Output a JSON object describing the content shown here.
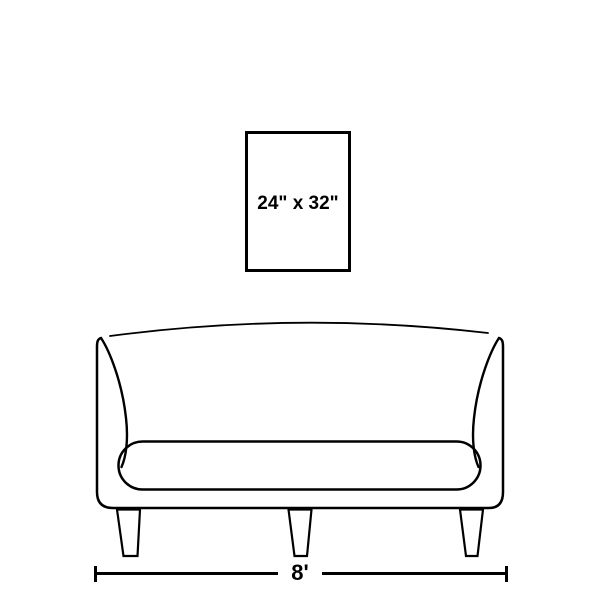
{
  "colors": {
    "line": "#000000",
    "background": "#ffffff"
  },
  "artwork": {
    "size_label": "24\" x 32\""
  },
  "sofa": {
    "width_label": "8'"
  }
}
